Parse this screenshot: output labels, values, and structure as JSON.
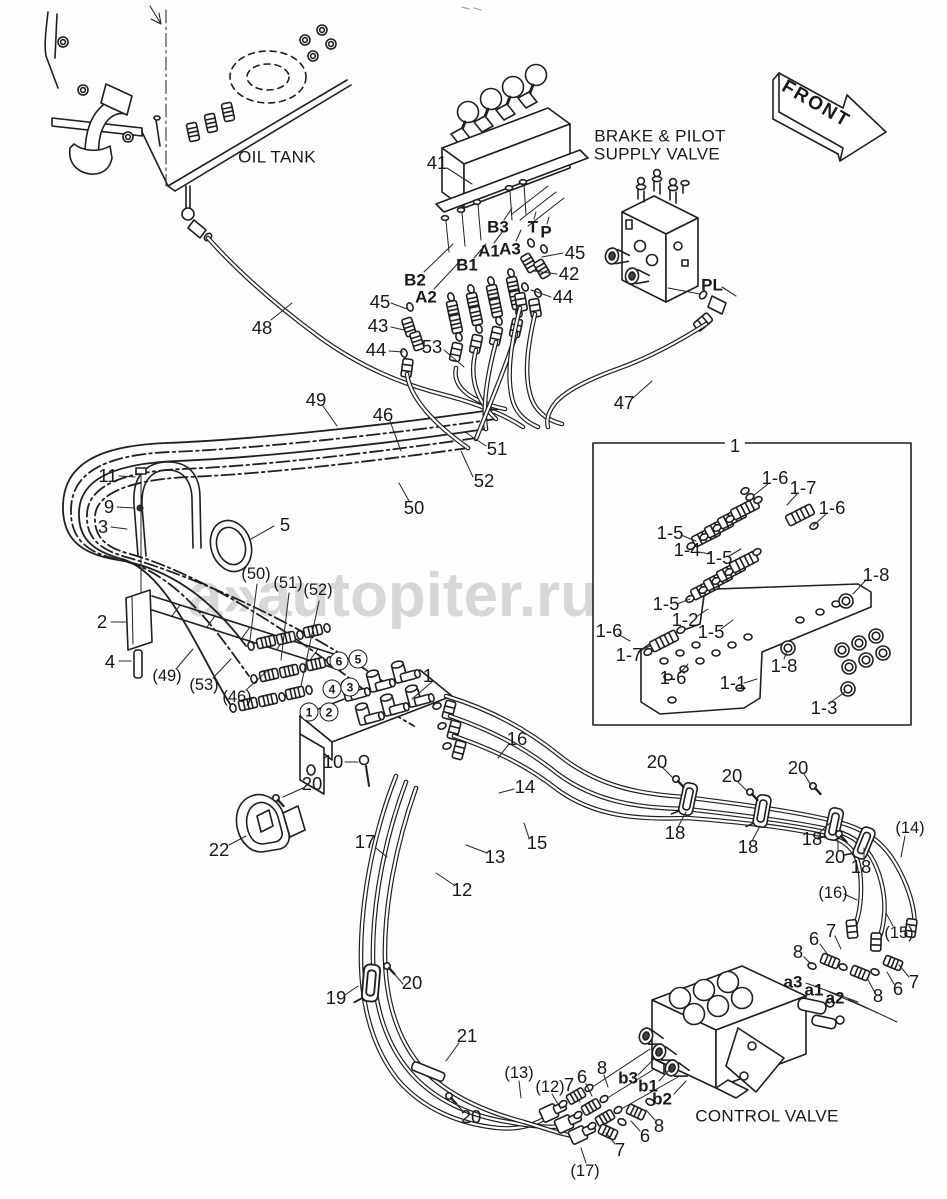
{
  "watermark": {
    "text": "a»autopiter.ru"
  },
  "colors": {
    "line": "#1f1f1f",
    "background": "#ffffff",
    "watermark": "#d3d3d3"
  },
  "diagram": {
    "labels": [
      {
        "t": "OIL TANK",
        "x": 277,
        "y": 157,
        "k": "cap"
      },
      {
        "t": "BRAKE & PILOT",
        "x": 660,
        "y": 136,
        "k": "cap"
      },
      {
        "t": "SUPPLY VALVE",
        "x": 657,
        "y": 154,
        "k": "cap"
      },
      {
        "t": "CONTROL VALVE",
        "x": 767,
        "y": 1116,
        "k": "cap"
      },
      {
        "t": "FRONT",
        "x": 816,
        "y": 104,
        "k": "front",
        "rot": 30
      },
      {
        "t": "41",
        "x": 437,
        "y": 163
      },
      {
        "t": "45",
        "x": 380,
        "y": 302
      },
      {
        "t": "43",
        "x": 378,
        "y": 326
      },
      {
        "t": "44",
        "x": 376,
        "y": 350
      },
      {
        "t": "53",
        "x": 432,
        "y": 347
      },
      {
        "t": "48",
        "x": 262,
        "y": 328
      },
      {
        "t": "45",
        "x": 575,
        "y": 253
      },
      {
        "t": "42",
        "x": 569,
        "y": 274
      },
      {
        "t": "44",
        "x": 563,
        "y": 297
      },
      {
        "t": "47",
        "x": 624,
        "y": 403
      },
      {
        "t": "49",
        "x": 316,
        "y": 400
      },
      {
        "t": "46",
        "x": 383,
        "y": 415
      },
      {
        "t": "51",
        "x": 497,
        "y": 449
      },
      {
        "t": "52",
        "x": 484,
        "y": 481
      },
      {
        "t": "50",
        "x": 414,
        "y": 508
      },
      {
        "t": "11",
        "x": 108,
        "y": 476
      },
      {
        "t": "9",
        "x": 109,
        "y": 507
      },
      {
        "t": "3",
        "x": 103,
        "y": 527
      },
      {
        "t": "5",
        "x": 285,
        "y": 525
      },
      {
        "t": "2",
        "x": 102,
        "y": 622
      },
      {
        "t": "4",
        "x": 110,
        "y": 662
      },
      {
        "t": "1",
        "x": 428,
        "y": 676
      },
      {
        "t": "10",
        "x": 333,
        "y": 762
      },
      {
        "t": "20",
        "x": 312,
        "y": 784
      },
      {
        "t": "22",
        "x": 219,
        "y": 850
      },
      {
        "t": "16",
        "x": 517,
        "y": 739
      },
      {
        "t": "14",
        "x": 525,
        "y": 787
      },
      {
        "t": "15",
        "x": 537,
        "y": 843
      },
      {
        "t": "13",
        "x": 495,
        "y": 857
      },
      {
        "t": "12",
        "x": 462,
        "y": 890
      },
      {
        "t": "17",
        "x": 365,
        "y": 842
      },
      {
        "t": "20",
        "x": 657,
        "y": 762
      },
      {
        "t": "18",
        "x": 675,
        "y": 833
      },
      {
        "t": "20",
        "x": 732,
        "y": 776
      },
      {
        "t": "18",
        "x": 748,
        "y": 847
      },
      {
        "t": "20",
        "x": 798,
        "y": 768
      },
      {
        "t": "18",
        "x": 812,
        "y": 839
      },
      {
        "t": "20",
        "x": 835,
        "y": 857
      },
      {
        "t": "18",
        "x": 861,
        "y": 867
      },
      {
        "t": "8",
        "x": 798,
        "y": 952
      },
      {
        "t": "6",
        "x": 814,
        "y": 939
      },
      {
        "t": "7",
        "x": 831,
        "y": 931
      },
      {
        "t": "8",
        "x": 878,
        "y": 996
      },
      {
        "t": "6",
        "x": 898,
        "y": 989
      },
      {
        "t": "7",
        "x": 914,
        "y": 982
      },
      {
        "t": "19",
        "x": 336,
        "y": 998
      },
      {
        "t": "20",
        "x": 412,
        "y": 983
      },
      {
        "t": "21",
        "x": 467,
        "y": 1036
      },
      {
        "t": "20",
        "x": 471,
        "y": 1117
      },
      {
        "t": "7",
        "x": 569,
        "y": 1085
      },
      {
        "t": "6",
        "x": 582,
        "y": 1077
      },
      {
        "t": "8",
        "x": 602,
        "y": 1068
      },
      {
        "t": "8",
        "x": 659,
        "y": 1126
      },
      {
        "t": "6",
        "x": 645,
        "y": 1136
      },
      {
        "t": "7",
        "x": 620,
        "y": 1150
      },
      {
        "t": "1",
        "x": 735,
        "y": 446,
        "k": "wbg"
      },
      {
        "t": "1-6",
        "x": 775,
        "y": 478
      },
      {
        "t": "1-7",
        "x": 803,
        "y": 488
      },
      {
        "t": "1-6",
        "x": 832,
        "y": 508
      },
      {
        "t": "1-5",
        "x": 670,
        "y": 533
      },
      {
        "t": "1-4",
        "x": 687,
        "y": 550
      },
      {
        "t": "1-5",
        "x": 719,
        "y": 558
      },
      {
        "t": "1-5",
        "x": 666,
        "y": 604
      },
      {
        "t": "1-2",
        "x": 685,
        "y": 620
      },
      {
        "t": "1-5",
        "x": 711,
        "y": 632
      },
      {
        "t": "1-6",
        "x": 609,
        "y": 631
      },
      {
        "t": "1-7",
        "x": 629,
        "y": 655
      },
      {
        "t": "1-6",
        "x": 673,
        "y": 678
      },
      {
        "t": "1-8",
        "x": 876,
        "y": 575
      },
      {
        "t": "1-8",
        "x": 784,
        "y": 666
      },
      {
        "t": "1-1",
        "x": 733,
        "y": 683
      },
      {
        "t": "1-3",
        "x": 824,
        "y": 708
      },
      {
        "t": "B2",
        "x": 415,
        "y": 280,
        "k": "bold"
      },
      {
        "t": "A2",
        "x": 426,
        "y": 297,
        "k": "bold"
      },
      {
        "t": "B1",
        "x": 467,
        "y": 265,
        "k": "bold"
      },
      {
        "t": "A1",
        "x": 489,
        "y": 251,
        "k": "bold"
      },
      {
        "t": "B3",
        "x": 498,
        "y": 227,
        "k": "bold"
      },
      {
        "t": "A3",
        "x": 510,
        "y": 249,
        "k": "bold"
      },
      {
        "t": "T",
        "x": 533,
        "y": 227,
        "k": "bold"
      },
      {
        "t": "P",
        "x": 546,
        "y": 232,
        "k": "bold"
      },
      {
        "t": "PL",
        "x": 712,
        "y": 285,
        "k": "bold"
      },
      {
        "t": "a3",
        "x": 793,
        "y": 982,
        "k": "bold"
      },
      {
        "t": "a1",
        "x": 814,
        "y": 990,
        "k": "bold"
      },
      {
        "t": "a2",
        "x": 835,
        "y": 998,
        "k": "bold"
      },
      {
        "t": "b3",
        "x": 628,
        "y": 1078,
        "k": "bold"
      },
      {
        "t": "b1",
        "x": 648,
        "y": 1086,
        "k": "bold"
      },
      {
        "t": "b2",
        "x": 662,
        "y": 1099,
        "k": "bold"
      },
      {
        "t": "(50)",
        "x": 256,
        "y": 574,
        "k": "par"
      },
      {
        "t": "(51)",
        "x": 288,
        "y": 583,
        "k": "par"
      },
      {
        "t": "(52)",
        "x": 318,
        "y": 590,
        "k": "par"
      },
      {
        "t": "(49)",
        "x": 167,
        "y": 676,
        "k": "par"
      },
      {
        "t": "(53)",
        "x": 204,
        "y": 685,
        "k": "par"
      },
      {
        "t": "(46)",
        "x": 237,
        "y": 697,
        "k": "par"
      },
      {
        "t": "(14)",
        "x": 910,
        "y": 828,
        "k": "par"
      },
      {
        "t": "(16)",
        "x": 833,
        "y": 893,
        "k": "par"
      },
      {
        "t": "(15)",
        "x": 899,
        "y": 933,
        "k": "par"
      },
      {
        "t": "(13)",
        "x": 519,
        "y": 1073,
        "k": "par"
      },
      {
        "t": "(12)",
        "x": 550,
        "y": 1087,
        "k": "par"
      },
      {
        "t": "(17)",
        "x": 585,
        "y": 1171,
        "k": "par"
      },
      {
        "t": "6",
        "x": 339,
        "y": 661,
        "k": "circ"
      },
      {
        "t": "5",
        "x": 358,
        "y": 659,
        "k": "circ"
      },
      {
        "t": "4",
        "x": 332,
        "y": 689,
        "k": "circ"
      },
      {
        "t": "3",
        "x": 350,
        "y": 687,
        "k": "circ"
      },
      {
        "t": "1",
        "x": 309,
        "y": 712,
        "k": "circ"
      },
      {
        "t": "2",
        "x": 329,
        "y": 712,
        "k": "circ"
      }
    ]
  }
}
